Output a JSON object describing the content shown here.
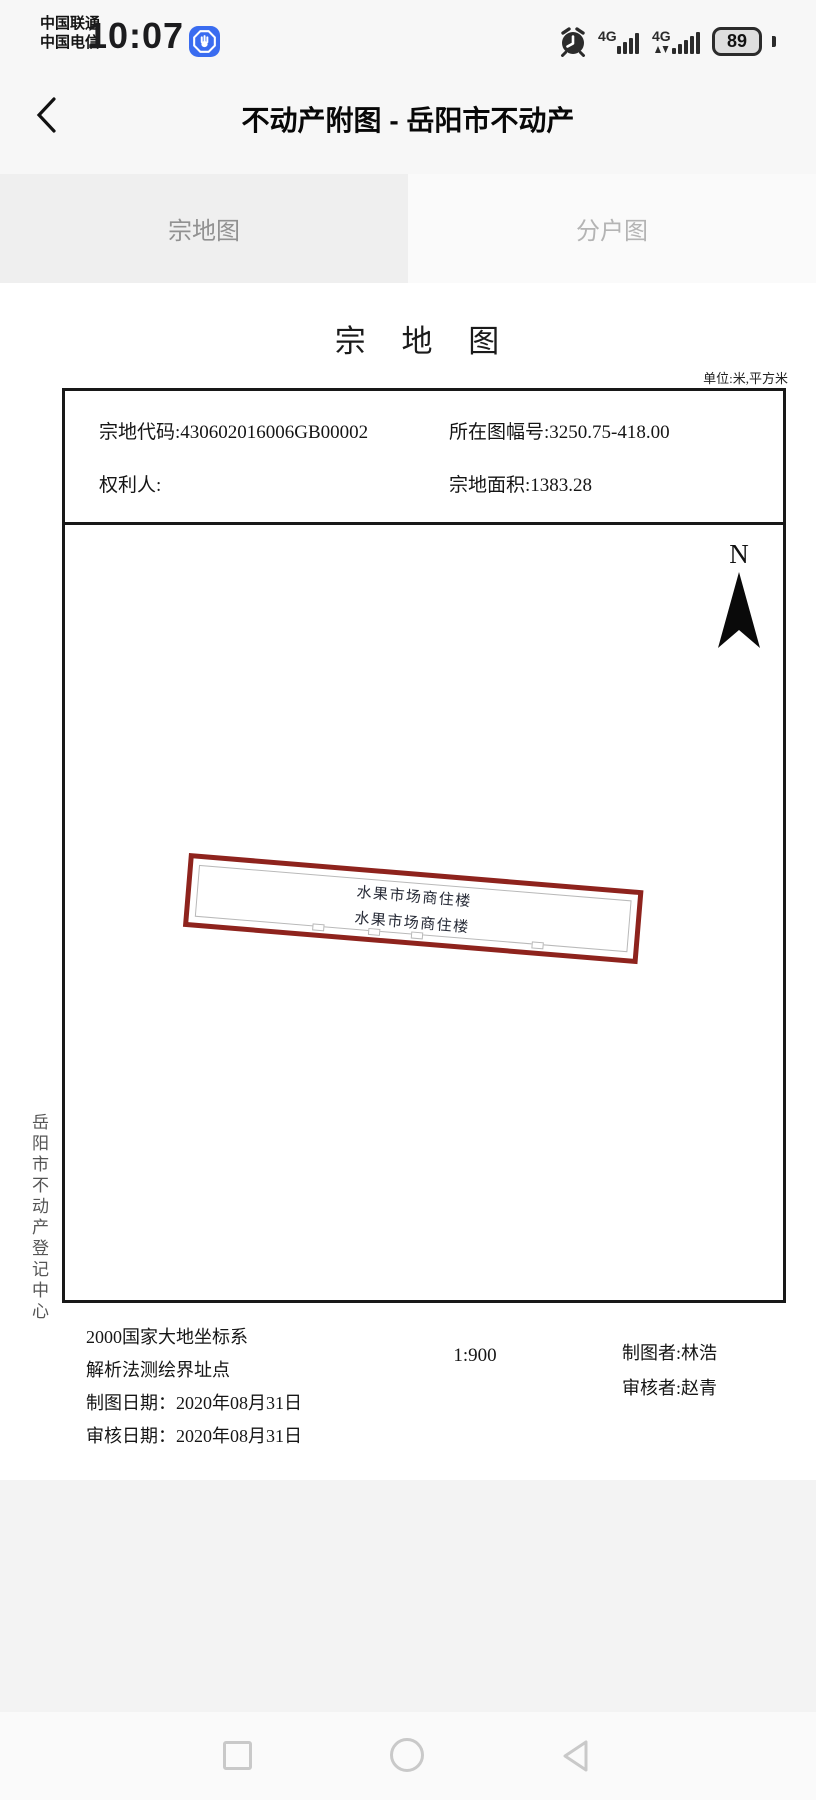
{
  "status_bar": {
    "carrier_line1": "中国联通",
    "carrier_line2": "中国电信",
    "time": "10:07",
    "network1_label": "4G",
    "network2_label": "4G",
    "battery_percent": "89",
    "icons": [
      "hand-permission-icon",
      "alarm-clock-icon",
      "4g-signal-icon",
      "4g-signal-arrows-icon",
      "battery-icon"
    ]
  },
  "header": {
    "title": "不动产附图 - 岳阳市不动产",
    "back_icon": "chevron-left-icon"
  },
  "tabs": {
    "left": "宗地图",
    "right": "分户图",
    "selected": "宗地图"
  },
  "doc": {
    "title": "宗 地 图",
    "unit_note": "单位:米,平方米",
    "info": {
      "parcel_code": "宗地代码:430602016006GB00002",
      "sheet_no": "所在图幅号:3250.75-418.00",
      "holder": "权利人:",
      "area": "宗地面积:1383.28"
    },
    "north_label": "N",
    "parcel": {
      "line1": "水果市场商住楼",
      "line2": "水果市场商住楼",
      "outline_color": "#8e231d",
      "inner_line_color": "#b9b9b9"
    },
    "side_label": "岳阳市不动产登记中心",
    "footer": {
      "coord_system": "2000国家大地坐标系",
      "survey_method": "解析法测绘界址点",
      "draw_date": "制图日期：2020年08月31日",
      "review_date": "审核日期：2020年08月31日",
      "scale": "1:900",
      "drafter": "制图者:林浩",
      "reviewer": "审核者:赵青"
    }
  },
  "nav_bar": {
    "icons": [
      "square-recents-icon",
      "circle-home-icon",
      "triangle-back-icon"
    ]
  },
  "colors": {
    "chrome_bg": "#f7f7f7",
    "tab_selected_bg": "#efefef",
    "tab_unselected_bg": "#fafafa",
    "accent_blue": "#3a6cf0",
    "parcel_red": "#8e231d"
  }
}
